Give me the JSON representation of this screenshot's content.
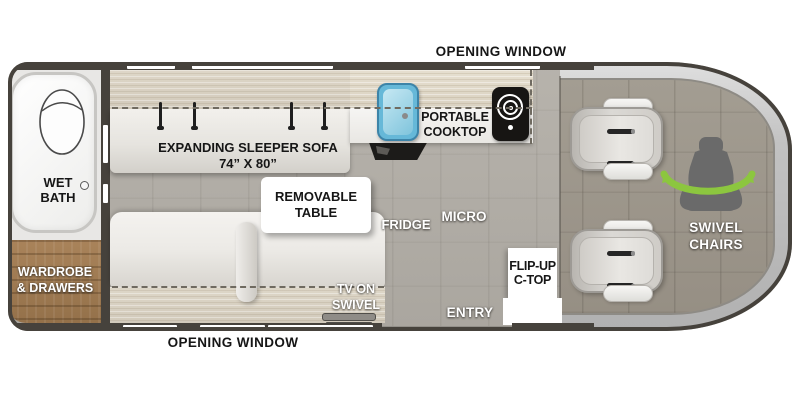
{
  "floorplan": {
    "opening_window_top": "OPENING WINDOW",
    "opening_window_bottom": "OPENING WINDOW",
    "wet_bath": [
      "WET",
      "BATH"
    ],
    "wardrobe": [
      "WARDROBE",
      "& DRAWERS"
    ],
    "sleeper_sofa": [
      "EXPANDING SLEEPER SOFA",
      "74” X 80”"
    ],
    "removable_table": [
      "REMOVABLE",
      "TABLE"
    ],
    "portable_cooktop": [
      "PORTABLE",
      "COOKTOP"
    ],
    "fridge": "FRIDGE",
    "micro": "MICRO",
    "tv_on_swivel": [
      "TV ON",
      "SWIVEL"
    ],
    "entry": "ENTRY",
    "flip_up_ctop": [
      "FLIP-UP",
      "C-TOP"
    ],
    "swivel_chairs": [
      "SWIVEL",
      "CHAIRS"
    ]
  },
  "icons": {
    "toilet-icon": "toilet outline in wet bath",
    "sink-icon": "blue kitchen sink",
    "burner-icon": "portable cooktop burner rings",
    "fridge-vent-icon": "black fridge vent wedge",
    "tv-icon": "tv on swivel bracket",
    "seat-icon": "captain chair top view",
    "swivel-chair-icon": "seat silhouette",
    "rotation-arrows-icon": "green swivel arc"
  },
  "colors": {
    "outline": "#46423C",
    "floor": "#B2AEA7",
    "cab_floor": "#9C968C",
    "wood": "#9A7850",
    "upholstery_band": "#D9D2C2",
    "cushion": "#F1EFEB",
    "sink_blue": "#66B8D8",
    "appliance_black": "#1B1A18",
    "swivel_green": "#8CC63F",
    "window_white": "#FFFFFF"
  }
}
